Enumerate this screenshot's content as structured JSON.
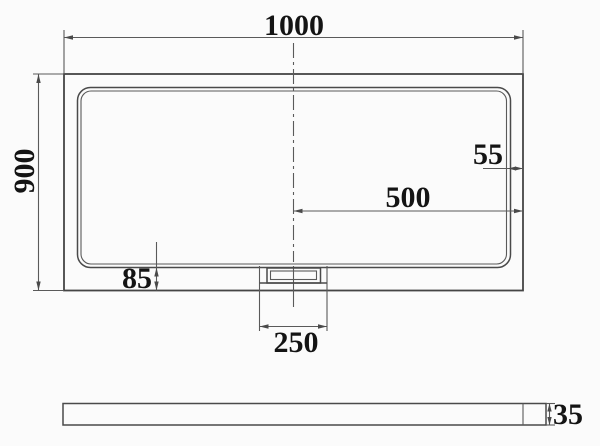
{
  "drawing_title": "Rectangular shower tray dimension drawing",
  "plan_view": {
    "dim_width": "1000",
    "dim_height": "900",
    "dim_rim_right": "55",
    "dim_center_to_edge": "500",
    "dim_rim_bottom": "85",
    "dim_drain_width": "250"
  },
  "side_view": {
    "dim_thickness": "35"
  },
  "colors": {
    "line": "#454545",
    "dimension_line": "#5a5a5a",
    "text": "#141414",
    "background": "#fbfbfb"
  }
}
